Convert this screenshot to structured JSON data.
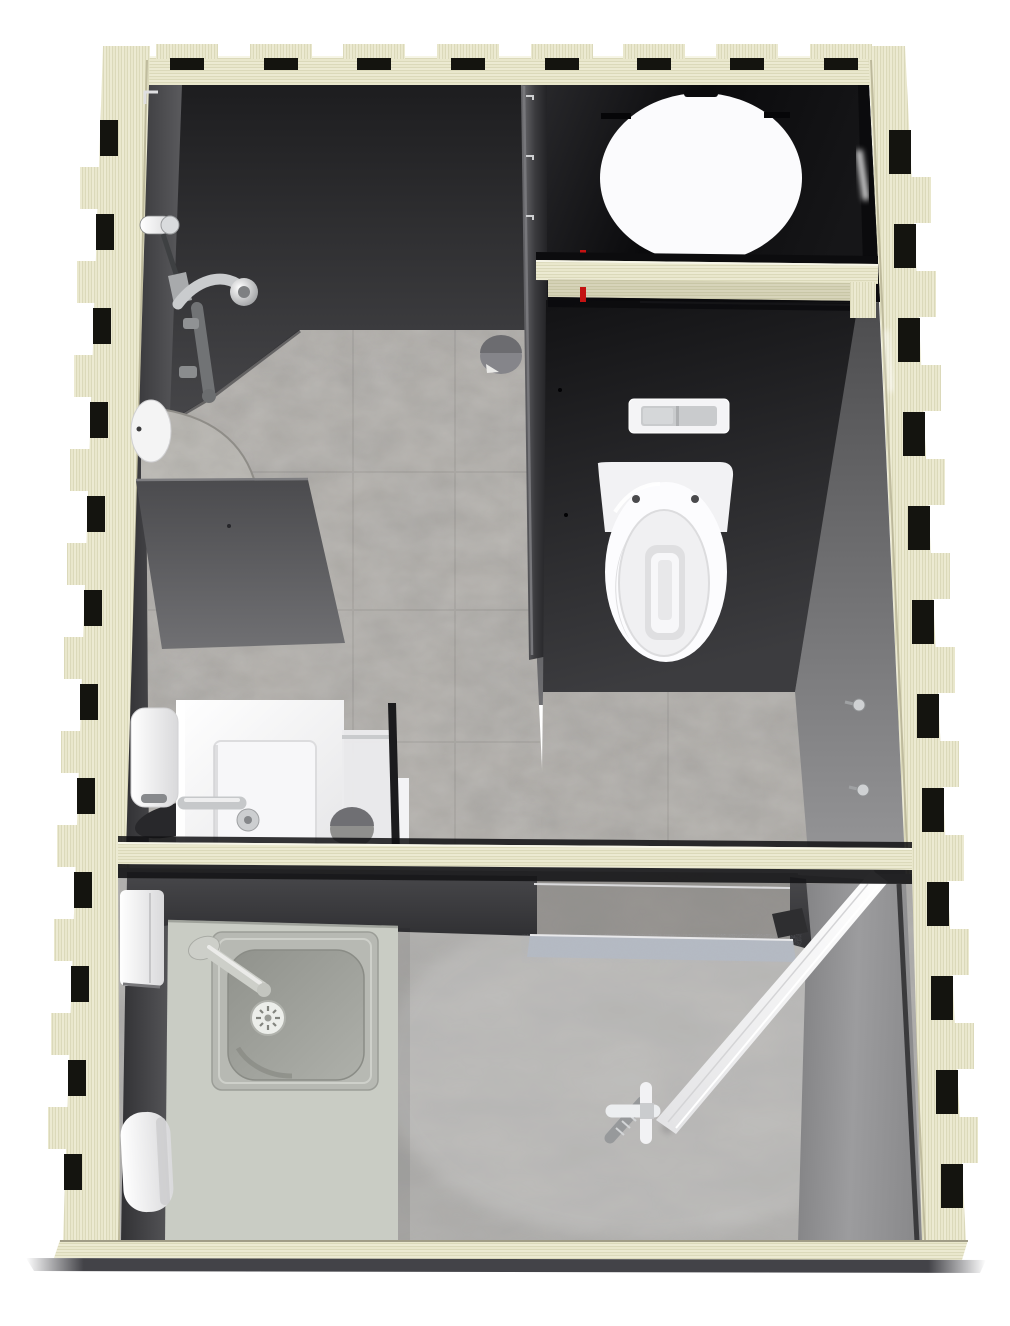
{
  "meta": {
    "description": "Top-down 3D architectural rendering of a prefabricated plywood sanitary module (bathroom pod) with shower room, toilet room and entry utility room",
    "view": "top-down-cutaway",
    "image_width": 1010,
    "image_height": 1326
  },
  "structure": {
    "frame": {
      "material": "plywood",
      "joinery": "castellated finger joints",
      "walls": [
        "top-wall",
        "left-wall",
        "right-wall",
        "bottom-wall"
      ],
      "beams": [
        "toilet-room-header-beam",
        "mid-partition-beam"
      ]
    },
    "rooms": [
      {
        "id": "shower-room",
        "label": "Shower room",
        "floor": "stone tile",
        "fixtures": [
          "shower-mixer-set",
          "corner-shelf",
          "wall-disc",
          "glass-partition",
          "vanity-washbasin",
          "basin-faucet",
          "soap-dispenser",
          "towel",
          "floor-disc"
        ]
      },
      {
        "id": "toilet-room",
        "label": "Toilet room",
        "floor": "stone tile",
        "fixtures": [
          "wall-hung-toilet",
          "flush-plate",
          "round-window",
          "red-pipe",
          "wall-hook-upper",
          "wall-hook-lower"
        ]
      },
      {
        "id": "entry-room",
        "label": "Entry / utility room",
        "floor": "concrete",
        "fixtures": [
          "steel-sink-unit",
          "sink-faucet",
          "sink-drain",
          "water-heater-box",
          "water-heater-cylinder",
          "entry-door",
          "door-handle",
          "doorway-threshold",
          "floor-bracket"
        ]
      }
    ]
  },
  "colors": {
    "background": "#ffffff",
    "wood": "#e9e7cc",
    "woodGrain": "#cdc9a6",
    "woodHighlight": "#f6f5e6",
    "woodShadow": "#b5b192",
    "notch": "#14140f",
    "wallDark": "#2d2d2f",
    "wallMid": "#58585a",
    "wallLight": "#98989a",
    "backWallBlack": "#0b0b0d",
    "panelCharcoal": "#1c1c1e",
    "floorStone": "#a5a3a0",
    "floorStoneMottle": "#99907f",
    "floorConcrete": "#a8a7a5",
    "counter": "#c9ccc4",
    "sinkPlate": "#b7b9b3",
    "basinSteel": "#a0a29c",
    "fixtureWhite": "#fbfbfd",
    "chrome": "#c6c8ca",
    "chromeDark": "#8e9092",
    "accentRed": "#c41212",
    "threshold": "#b5bac3",
    "discGray": "#8c8c8e",
    "towelDark": "#28282b",
    "groundShadow": "#434348"
  }
}
